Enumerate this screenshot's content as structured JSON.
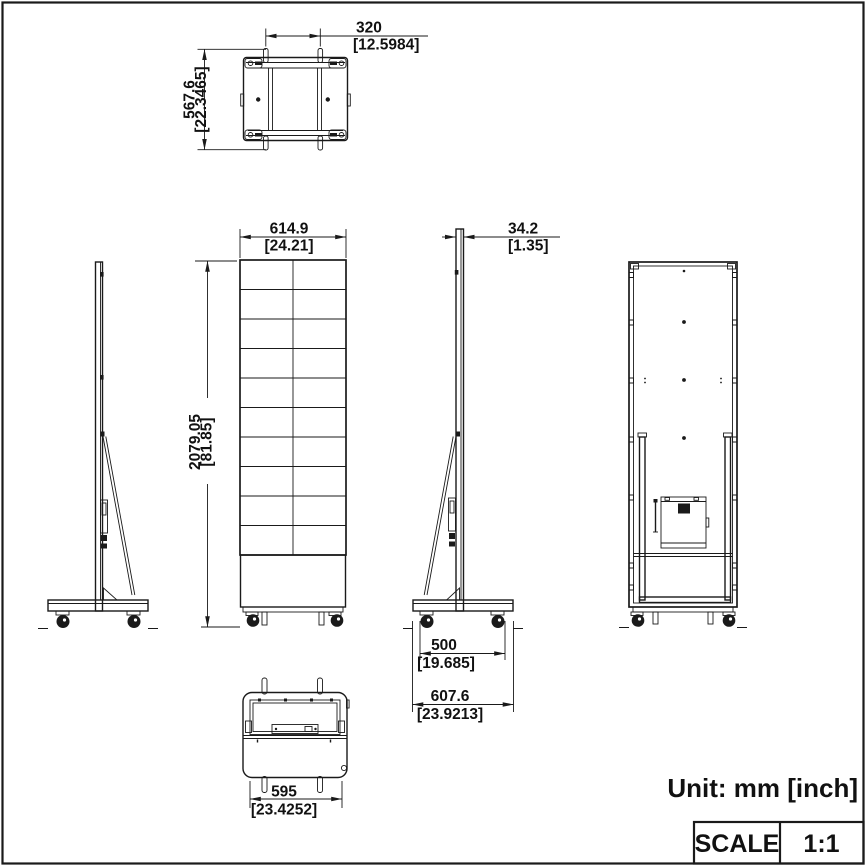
{
  "dimensions": {
    "top_width": {
      "mm": "320",
      "inch": "[12.5984]"
    },
    "top_depth": {
      "mm": "567.6",
      "inch": "[22.3465]"
    },
    "screen_width": {
      "mm": "614.9",
      "inch": "[24.21]"
    },
    "overall_height": {
      "mm": "2079.05",
      "inch": "[81.85]"
    },
    "panel_thickness": {
      "mm": "34.2",
      "inch": "[1.35]"
    },
    "base_inner_depth": {
      "mm": "500",
      "inch": "[19.685]"
    },
    "base_depth": {
      "mm": "607.6",
      "inch": "[23.9213]"
    },
    "base_width": {
      "mm": "595",
      "inch": "[23.4252]"
    }
  },
  "legend": {
    "unit_note": "Unit: mm [inch]",
    "scale_label": "SCALE",
    "scale_value": "1:1"
  },
  "colors": {
    "line": "#1a1a1a",
    "background": "#ffffff"
  }
}
